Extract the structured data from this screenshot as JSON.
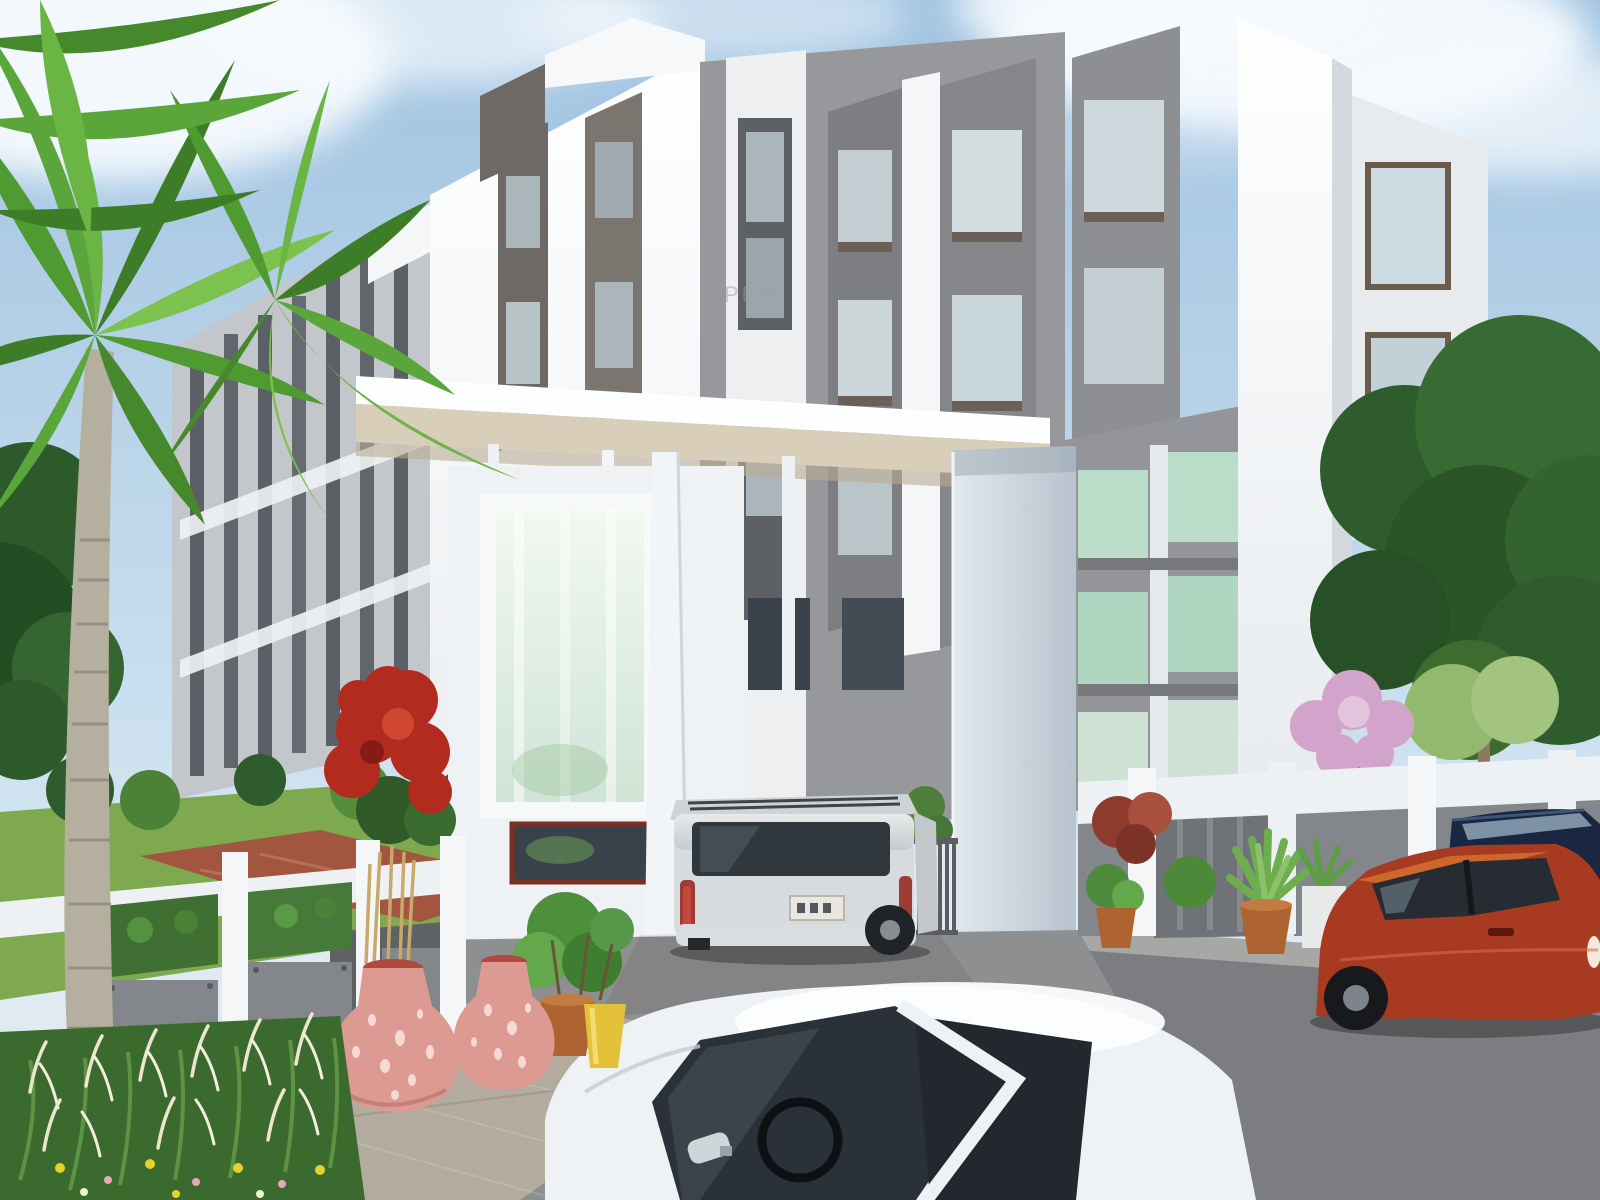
{
  "scene": {
    "type": "3d-architectural-rendering",
    "subject": "Modern white-and-grey residential apartment complex with entrance gateway canopy, compound walls, landscaping and cars",
    "watermark": {
      "text": "PRO"
    },
    "objects": [
      "sky",
      "clouds",
      "bird",
      "palm-trees",
      "apartment-building",
      "entrance-canopy",
      "glass-feature-panel",
      "entrance-pillar",
      "driveway-gate",
      "compound-wall-left",
      "compound-wall-right",
      "silver-suv",
      "white-hatchback-foreground",
      "red-hatchback",
      "navy-car",
      "pink-urns",
      "terracotta-pots",
      "yellow-pot",
      "red-flower-bush",
      "pink-flower-tree",
      "ornamental-grass",
      "lawn",
      "red-paved-path",
      "driveway",
      "street"
    ]
  },
  "palette": {
    "sky_top": "#9fc2e0",
    "sky_bottom": "#d6e7f3",
    "cloud": "#f7fbfe",
    "building_white": "#f2f4f6",
    "facade_gray": "#97989c",
    "frame_gray": "#6e6964",
    "glass_green": "#bfe0d0",
    "glass_dark": "#39424a",
    "canopy_fascia": "#d8ceba",
    "glass_panel_tint": "#cfe4d5",
    "asphalt": "#8e8f91",
    "street": "#7b7d80",
    "paver": "#b3ab9e",
    "lawn": "#7fa94e",
    "path_red": "#a2553f",
    "foliage_dark": "#2f5c2c",
    "foliage": "#4c8a3a",
    "palm_green": "#5aa63b",
    "flower_red": "#b32a1f",
    "blossom_pink": "#d2a3cb",
    "urn_pink": "#dd9a92",
    "terracotta": "#ad6430",
    "pot_yellow": "#e3c23a",
    "suv_silver": "#d8dbdd",
    "car_red_body": "#a83a22",
    "car_navy": "#1a2740",
    "car_white": "#eef2f5",
    "gate_metal": "#5a5e62",
    "fence_panel": "#83868a",
    "wall_white": "#eef1f3",
    "watermark_gray": "#9aa0a4"
  }
}
